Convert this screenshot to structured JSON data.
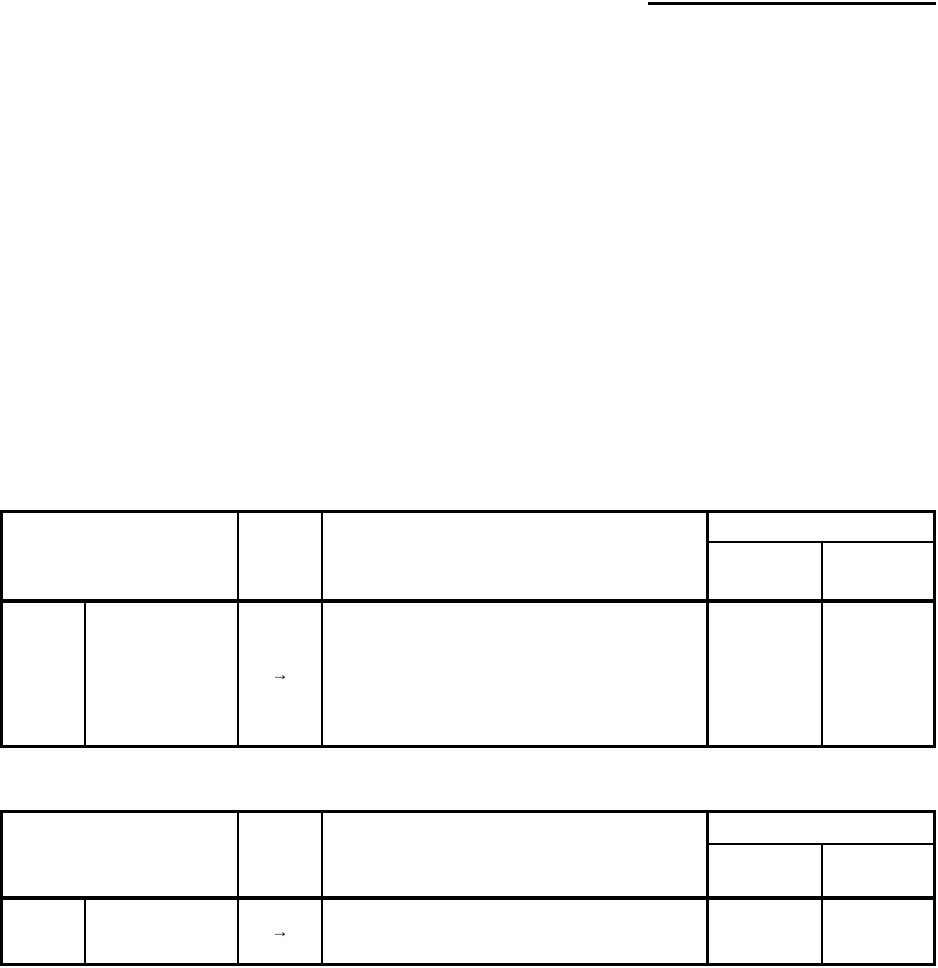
{
  "page": {
    "background_color": "#ffffff",
    "line_color": "#000000"
  },
  "tables": {
    "table1": {
      "body_row": {
        "arrow": "→"
      }
    },
    "table2": {
      "body_row": {
        "arrow": "→"
      }
    }
  }
}
